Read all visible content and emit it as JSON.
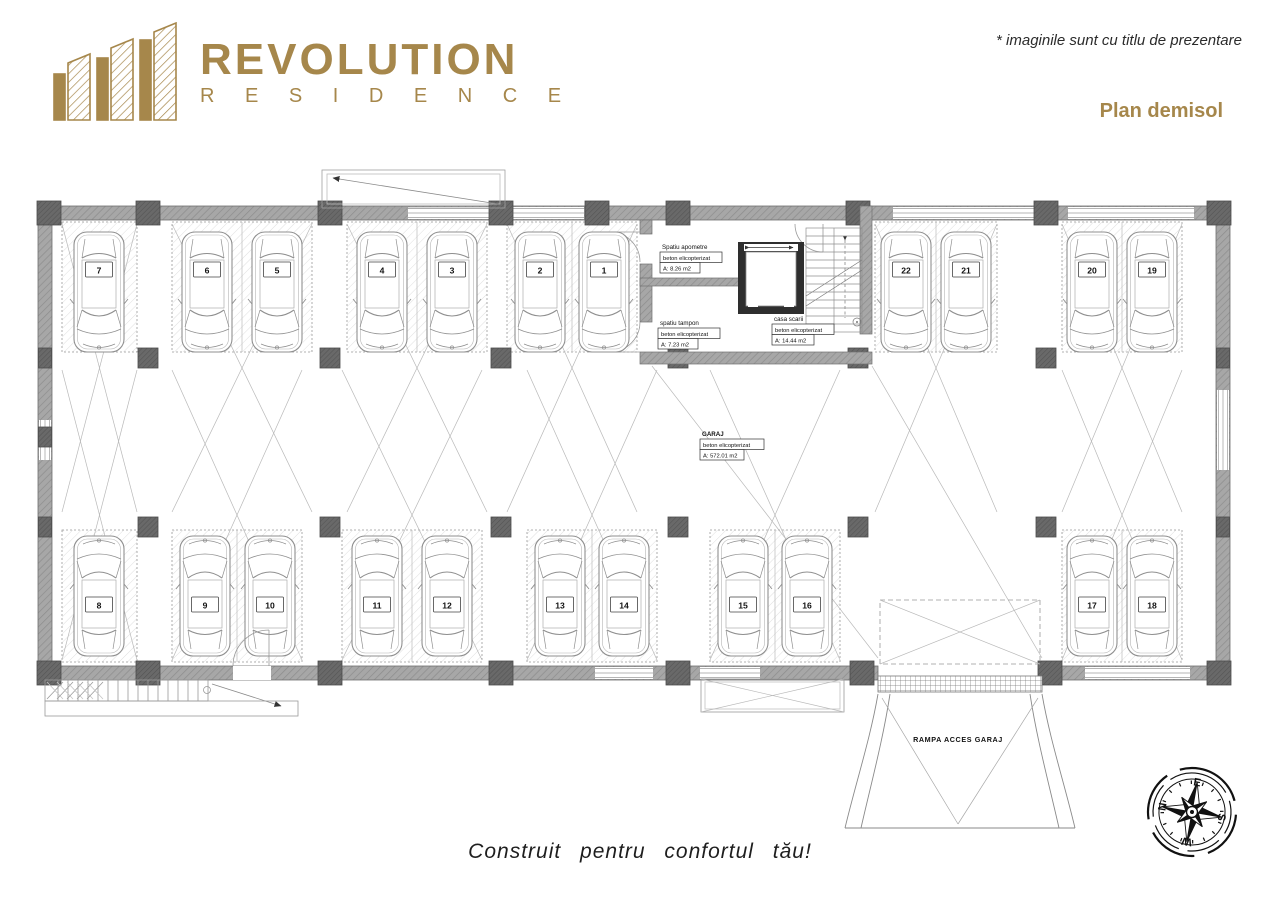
{
  "header": {
    "logo_title": "REVOLUTION",
    "logo_subtitle": "R E S I D E N C E",
    "disclaimer": "* imaginile sunt cu titlu de prezentare",
    "plan_title": "Plan demisol"
  },
  "footer": {
    "tagline": "Construit pentru confortul tău!"
  },
  "colors": {
    "brand_gold": "#A6874B",
    "wall_gray": "#a7a7a7",
    "column_gray": "#686868",
    "line_gray": "#8a8a8a",
    "text_dark": "#222222"
  },
  "plan": {
    "garage_label": {
      "name": "GARAJ",
      "material": "beton elicopterizat",
      "area": "A: 572.01 m2"
    },
    "rooms": [
      {
        "name": "Spatiu apometre",
        "material": "beton elicopterizat",
        "area": "A: 8.26 m2"
      },
      {
        "name": "spatiu tampon",
        "material": "beton elicopterizat",
        "area": "A: 7.23 m2"
      },
      {
        "name": "casa scarii",
        "material": "beton elicopterizat",
        "area": "A: 14.44 m2"
      }
    ],
    "ramp_label": "RAMPA ACCES GARAJ",
    "parking_spots": [
      "1",
      "2",
      "3",
      "4",
      "5",
      "6",
      "7",
      "8",
      "9",
      "10",
      "11",
      "12",
      "13",
      "14",
      "15",
      "16",
      "17",
      "18",
      "19",
      "20",
      "21",
      "22"
    ],
    "compass": {
      "n": "N",
      "e": "E",
      "s": "S",
      "w": "W"
    }
  }
}
